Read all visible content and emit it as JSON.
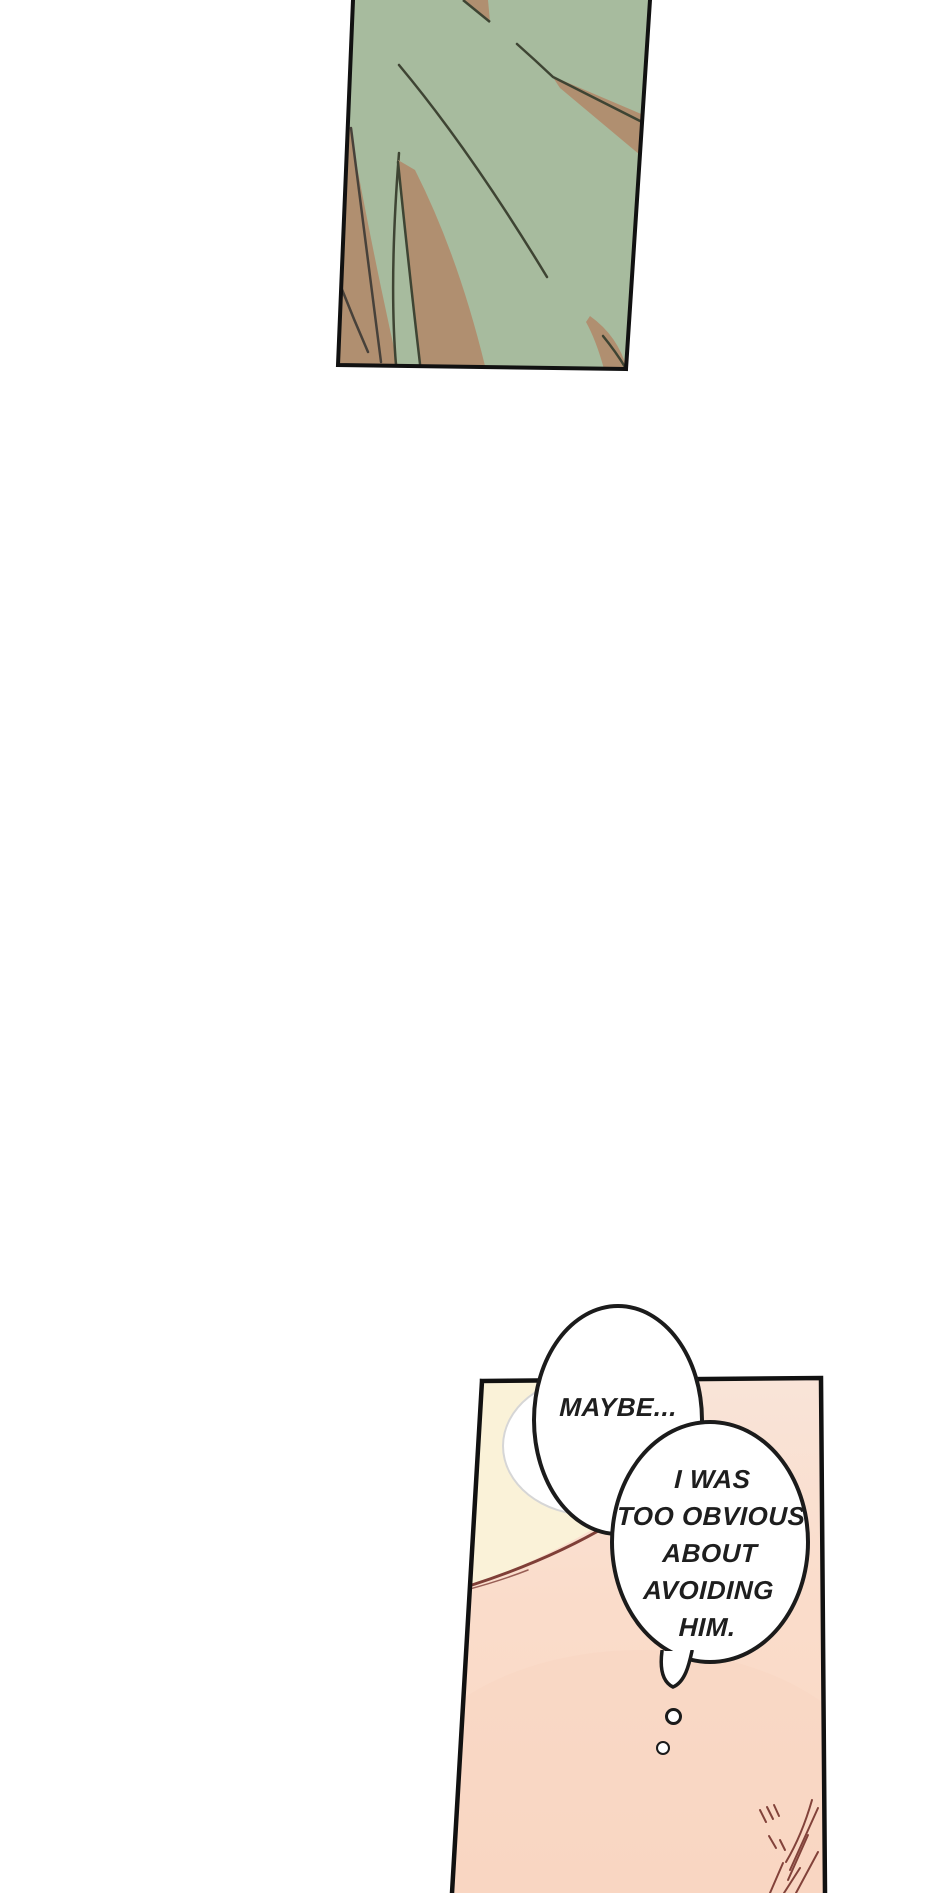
{
  "page": {
    "width": 940,
    "height": 1893,
    "background": "#ffffff",
    "type_label": "webtoon comic page"
  },
  "panels": {
    "foliage": {
      "description": "slanted borderless-top panel: close-up of green foliage with tan leaf blades and scratch lines",
      "colors": {
        "background": "#a7bb9e",
        "leaves": "#b08f70",
        "linework": "#3e4433",
        "border": "#111111"
      }
    },
    "bedroom": {
      "description": "slanted panel cut off at page bottom: pale yellow wall, maroon seam line, pink bedding, hair strokes in lower right corner",
      "colors": {
        "wall_yellow": "#faf2d8",
        "bedding_top": "#f9e4d8",
        "bedding_bottom": "#fbd8c5",
        "hair_lines": "#7f3f37",
        "border": "#111111"
      }
    }
  },
  "bubbles": {
    "thought1": {
      "text": "MAYBE...",
      "fill": "#ffffff",
      "outline": "#1b1b1b"
    },
    "thought2": {
      "lines": [
        "I WAS",
        "TOO OBVIOUS",
        "ABOUT",
        "AVOIDING",
        "HIM."
      ],
      "fill": "#ffffff",
      "outline": "#1b1b1b"
    },
    "trail_circle_count": 2
  }
}
